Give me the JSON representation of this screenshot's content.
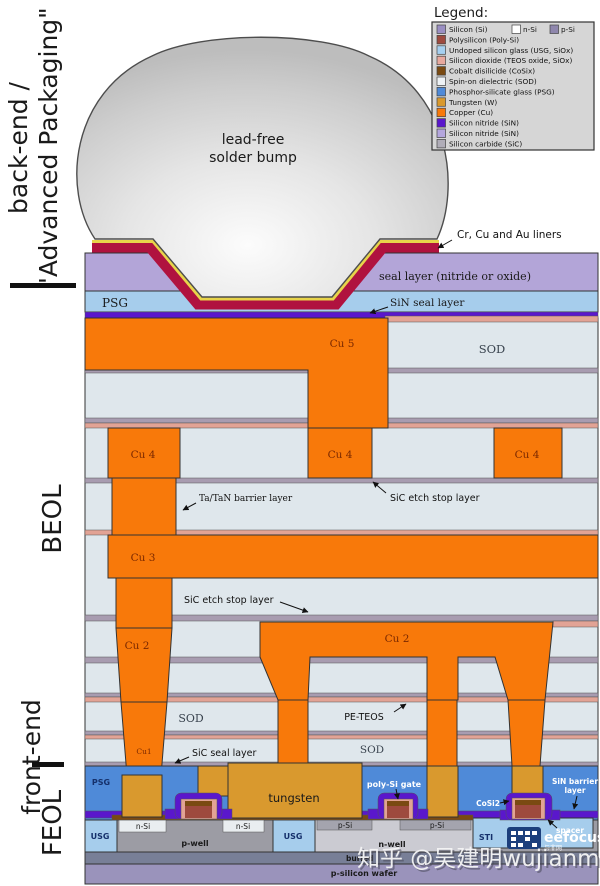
{
  "side": {
    "backend1": "back-end /",
    "backend2": "\"Advanced Packaging\"",
    "beol": "BEOL",
    "frontend": "front-end",
    "feol": "FEOL"
  },
  "legend": {
    "title": "Legend:",
    "si_extra": {
      "n_label": "n-Si",
      "n_color": "#ffffff",
      "p_label": "p-Si",
      "p_color": "#8f87ad"
    },
    "items": [
      {
        "label": "Silicon (Si)",
        "color": "#9a8fc2"
      },
      {
        "label": "Polysilicon (Poly-Si)",
        "color": "#9e4a3e"
      },
      {
        "label": "Undoped silicon glass (USG, SiOx)",
        "color": "#a6d0f0"
      },
      {
        "label": "Silicon dioxide (TEOS oxide, SiOx)",
        "color": "#e8a99e"
      },
      {
        "label": "Cobalt disilicide (CoSix)",
        "color": "#7a4a12"
      },
      {
        "label": "Spin-on dielectric (SOD)",
        "color": "#eef2f5"
      },
      {
        "label": "Phosphor-silicate glass (PSG)",
        "color": "#4f8ad8"
      },
      {
        "label": "Tungsten (W)",
        "color": "#d9992e"
      },
      {
        "label": "Copper (Cu)",
        "color": "#f8790a"
      },
      {
        "label": "Silicon nitride (SiN)",
        "color": "#5a17cc"
      },
      {
        "label": "Silicon nitride (SiN)",
        "color": "#b4a6dd"
      },
      {
        "label": "Silicon carbide (SiC)",
        "color": "#b0adb8"
      }
    ]
  },
  "bump": {
    "line1": "lead-free",
    "line2": "solder bump"
  },
  "annotations": {
    "liners": "Cr, Cu and Au liners",
    "seal_layer": "seal layer (nitride or oxide)",
    "psg_top": "PSG",
    "sin_seal": "SiN seal layer",
    "cu5": "Cu 5",
    "sod": "SOD",
    "cu4": "Cu 4",
    "ta_tan": "Ta/TaN barrier layer",
    "sic_etch": "SiC etch stop layer",
    "cu3": "Cu 3",
    "cu2": "Cu 2",
    "pe_teos": "PE-TEOS",
    "cu1": "Cu1",
    "sic_seal": "SiC seal layer",
    "psg_bottom": "PSG",
    "tungsten": "tungsten",
    "poly_gate": "poly-Si gate",
    "sin_barrier_l1": "SiN barrier",
    "sin_barrier_l2": "layer",
    "cosi2": "CoSi2",
    "spacer": "spacer",
    "usg": "USG",
    "sti": "STI",
    "n_si": "n-Si",
    "p_well": "p-well",
    "p_si": "p-Si",
    "n_well": "n-well",
    "buried": "buried",
    "wafer": "p-silicon wafer"
  },
  "watermark": "知乎 @吴建明wujianming",
  "logo": {
    "name": "eefocus",
    "sub": "与非网"
  },
  "colors": {
    "seal_lavender": "#b3a5d8",
    "liner_crimson": "#b0123f",
    "liner_gold": "#e8d44a",
    "usg_blue": "#a6cdec",
    "sin_purple": "#5a17cc",
    "teos_pink": "#e2a395",
    "sic_mauve": "#a89cb0",
    "sod": "#dfe7ec",
    "copper": "#f8790a",
    "tungsten": "#d9992e",
    "psg_blue": "#4f8ad8",
    "p_well": "#9c9ca4",
    "n_well": "#cbcbd2",
    "n_si": "#e9edf0",
    "p_si": "#a4a4ae",
    "buried": "#787f97",
    "wafer": "#9a93bb",
    "cosi2": "#7a4a12",
    "poly": "#9e4a3e",
    "bump_gray": "#c9c9c9"
  }
}
